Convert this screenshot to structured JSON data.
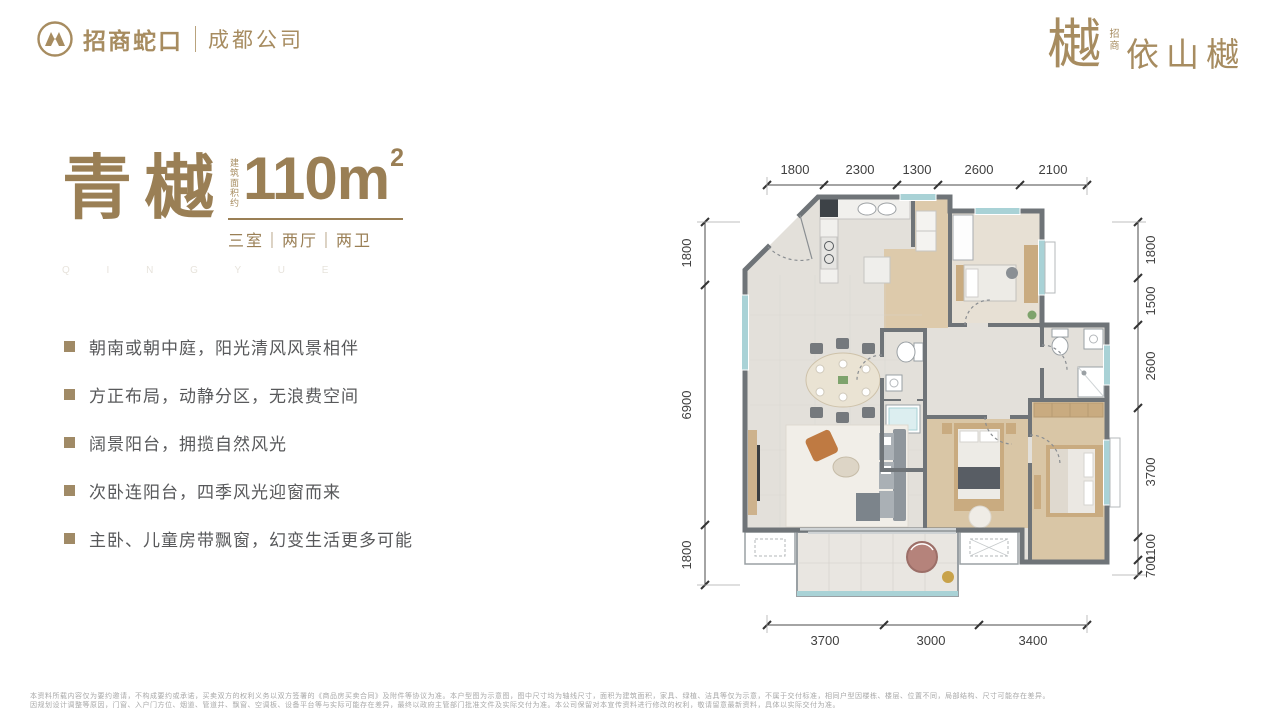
{
  "header": {
    "brand": {
      "name": "招商蛇口",
      "sub": "成都公司"
    },
    "project": {
      "mark": "樾",
      "small": "招商",
      "name": "依山樾"
    }
  },
  "hero": {
    "name": "青樾",
    "area_label": "建筑面积约",
    "area_value": "110m",
    "area_sup": "2",
    "rooms": "三室｜两厅｜两卫",
    "watermark": "Q I N G Y U E"
  },
  "features": {
    "items": [
      "朝南或朝中庭，阳光清风风景相伴",
      "方正布局，动静分区，无浪费空间",
      "阔景阳台，拥揽自然风光",
      "次卧连阳台，四季风光迎窗而来",
      "主卧、儿童房带飘窗，幻变生活更多可能"
    ]
  },
  "floorplan": {
    "dims_top": [
      "1800",
      "2300",
      "1300",
      "2600",
      "2100"
    ],
    "dims_bottom": [
      "3700",
      "3000",
      "3400"
    ],
    "dims_left": [
      "1800",
      "6900",
      "1800"
    ],
    "dims_right": [
      "1800",
      "1500",
      "2600",
      "3700",
      "1100",
      "700"
    ]
  },
  "footer": {
    "line1": "本资料所载内容仅为要约邀请，不构成要约或承诺，买卖双方的权利义务以双方签署的《商品房买卖合同》及附件等协议为准。本户型图为示意图，图中尺寸均为轴线尺寸，面积为建筑面积，家具、绿植、洁具等仅为示意，不属于交付标准，相同户型因楼栋、楼层、位置不同，局部结构、尺寸可能存在差异。",
    "line2": "因规划设计调整等原因，门窗、入户门方位、烟道、管道井、飘窗、空调板、设备平台等与实际可能存在差异，最终以政府主管部门批准文件及实际交付为准。本公司保留对本宣传资料进行修改的权利，敬请留意最新资料，具体以实际交付为准。"
  },
  "colors": {
    "bronze": "#a78c60",
    "title": "#9a7f55",
    "text": "#58595b",
    "wall": "#6f7478",
    "window": "#a9d2d6"
  }
}
